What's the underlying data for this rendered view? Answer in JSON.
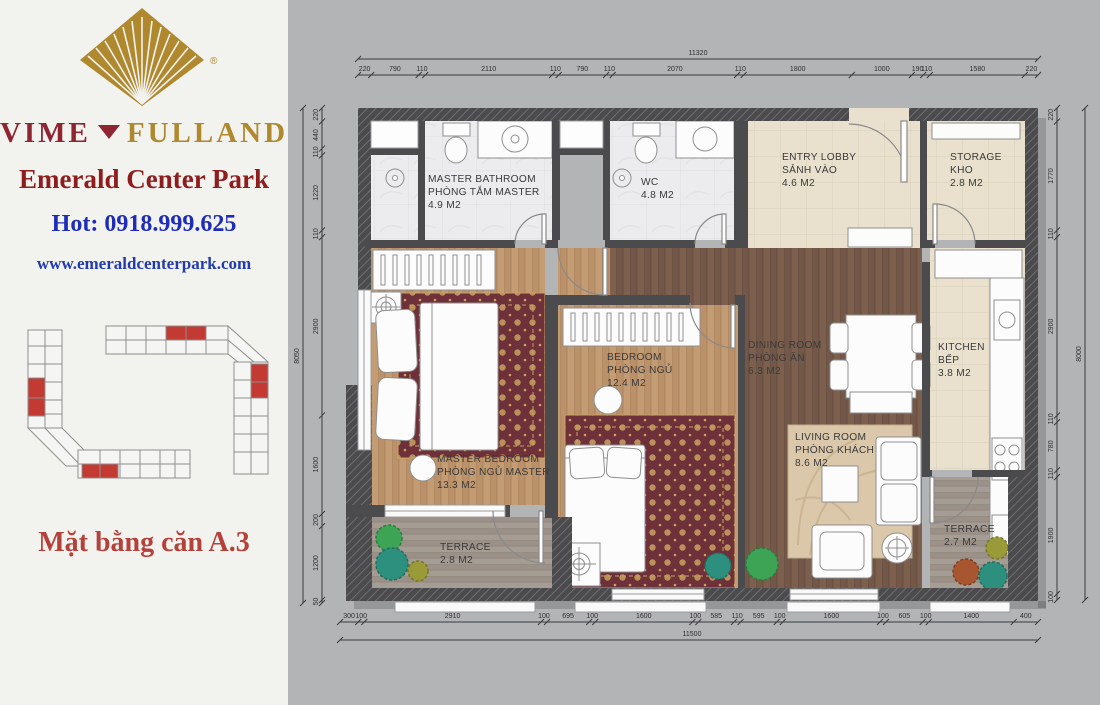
{
  "sidebar": {
    "brand": {
      "left": "VIME",
      "right": "FULLAND",
      "reg": "®"
    },
    "project_name": "Emerald Center Park",
    "hotline": "Hot: 0918.999.625",
    "website": "www.emeraldcenterpark.com",
    "caption": "Mặt bằng căn A.3"
  },
  "colors": {
    "brand_red": "#8e2531",
    "brand_gold": "#b0892f",
    "project_red": "#8f1d1d",
    "hotline_blue": "#1e2cb8",
    "website_blue": "#223bb0",
    "caption_red": "#b5423a",
    "highlight_red": "#c23a31",
    "wall": "#4b4b4d",
    "carpet": "#6e3039",
    "carpet_gold": "#c9a262"
  },
  "plan": {
    "rooms": [
      {
        "id": "master-bathroom",
        "name_en": "MASTER BATHROOM",
        "name_vn": "PHÒNG TẮM MASTER",
        "area": "4.9 M2"
      },
      {
        "id": "wc",
        "name_en": "WC",
        "area": "4.8 M2"
      },
      {
        "id": "entry-lobby",
        "name_en": "ENTRY LOBBY",
        "name_vn": "SẢNH VÀO",
        "area": "4.6 M2"
      },
      {
        "id": "storage",
        "name_en": "STORAGE",
        "name_vn": "KHO",
        "area": "2.8 M2"
      },
      {
        "id": "master-bedroom",
        "name_en": "MASTER BEDROOM",
        "name_vn": "PHÒNG NGỦ MASTER",
        "area": "13.3 M2"
      },
      {
        "id": "bedroom",
        "name_en": "BEDROOM",
        "name_vn": "PHÒNG NGỦ",
        "area": "12.4 M2"
      },
      {
        "id": "dining-room",
        "name_en": "DINING ROOM",
        "name_vn": "PHÒNG ĂN",
        "area": "6.3 M2"
      },
      {
        "id": "kitchen",
        "name_en": "KITCHEN",
        "name_vn": "BẾP",
        "area": "3.8 M2"
      },
      {
        "id": "living-room",
        "name_en": "LIVING ROOM",
        "name_vn": "PHÒNG KHÁCH",
        "area": "8.6 M2"
      },
      {
        "id": "terrace-left",
        "name_en": "TERRACE",
        "area": "2.8 M2"
      },
      {
        "id": "terrace-right",
        "name_en": "TERRACE",
        "area": "2.7 M2"
      }
    ],
    "dimensions": {
      "top": {
        "total": "11320",
        "segments": [
          220,
          790,
          110,
          2110,
          110,
          790,
          110,
          2070,
          110,
          1800,
          1000,
          190,
          110,
          1580,
          220
        ]
      },
      "bottom": {
        "total": "11500",
        "segments": [
          300,
          100,
          2910,
          100,
          695,
          100,
          1600,
          100,
          585,
          110,
          595,
          100,
          1600,
          100,
          605,
          100,
          1400,
          400
        ]
      },
      "left": {
        "total": "8050",
        "segments": [
          220,
          440,
          110,
          1220,
          110,
          2900,
          1600,
          200,
          1200,
          50
        ]
      },
      "right": {
        "total": "8000",
        "segments": [
          220,
          1770,
          110,
          2900,
          110,
          780,
          110,
          1900,
          100
        ]
      }
    }
  }
}
